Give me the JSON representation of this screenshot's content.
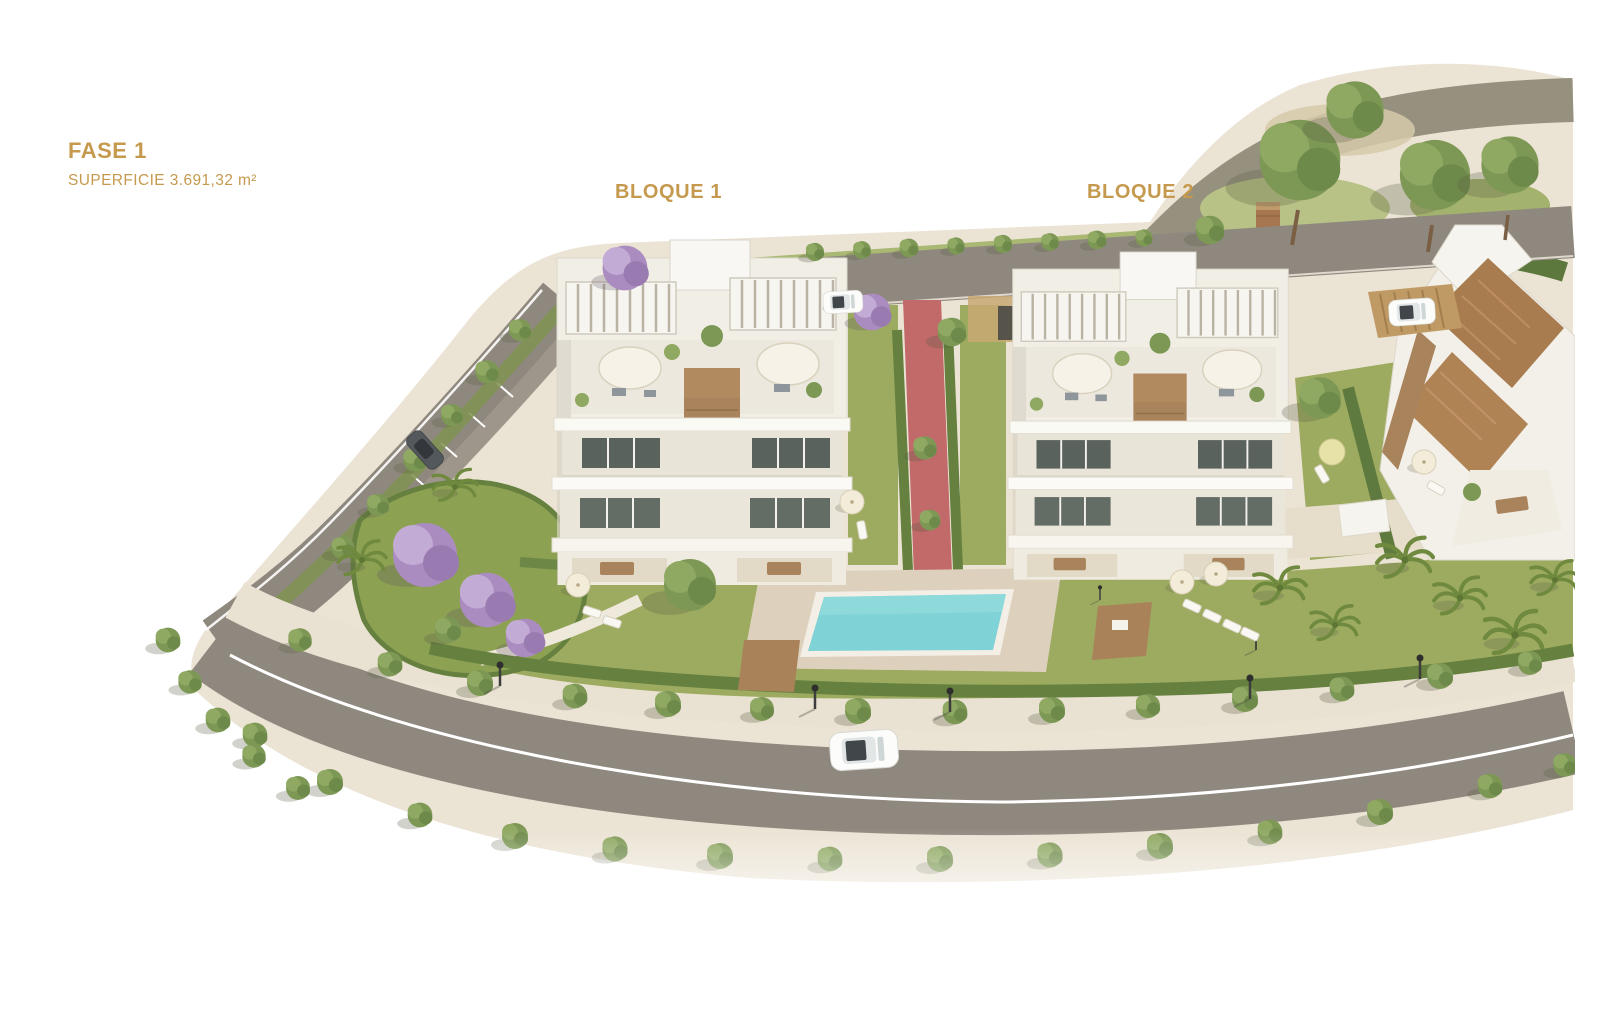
{
  "labels": {
    "phase_title": "FASE 1",
    "phase_subtitle": "SUPERFICIE 3.691,32 m²",
    "block1": "BLOQUE 1",
    "block2": "BLOQUE 2"
  },
  "colors": {
    "label_gold": "#c59a4e",
    "background": "#ffffff",
    "grass": "#9dab60",
    "grass_light": "#b8c286",
    "road": "#8f887e",
    "sidewalk_base": "#ebe3d4",
    "pool_water": "#7fd2d6",
    "pool_deck": "#ddd1bd",
    "walk_path_red": "#c2696a",
    "hedge": "#66813f",
    "tree_green": "#7d9855",
    "jacaranda_purple": "#ab8cc0",
    "wood": "#a8835c",
    "roof_tile": "#a97c50",
    "building_white": "#f2efe8"
  },
  "scene_objects": {
    "blocks_visible": 3,
    "pool": "rectangular turquoise pool",
    "cars": [
      "white car on main road",
      "dark car parked on side road",
      "white car on upper road",
      "white car under carport"
    ]
  }
}
